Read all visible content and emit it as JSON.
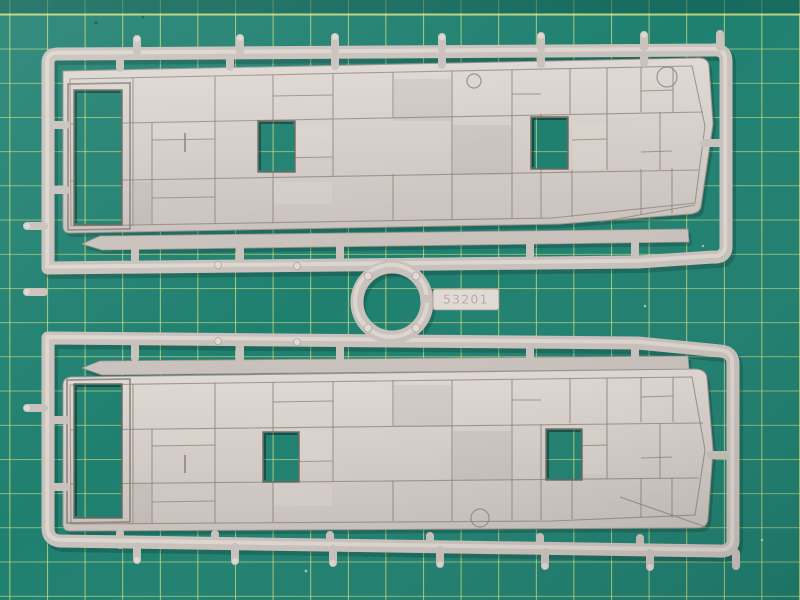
{
  "scene": {
    "subject": "plastic-model-sprue",
    "background": "green-cutting-mat",
    "description": "Light grey injection-moulded model kit sprue holding two large panelled wagon sides, joined by a central circular runner ring with an embossed part-number tag, photographed on a green self-healing cutting mat with a yellow grid."
  },
  "sprue": {
    "part_number": "53201"
  },
  "colors": {
    "mat_green": "#1f8070",
    "mat_band": "#0d5a50",
    "grid_line": "#dde47f",
    "plastic": "#c9c1bc",
    "plastic_hi": "#e0d9d4",
    "plastic_shadow": "#9d948f",
    "groove": "#8a817a",
    "hole_edge": "#6d655f",
    "shadow": "rgba(10,35,30,0.25)"
  }
}
